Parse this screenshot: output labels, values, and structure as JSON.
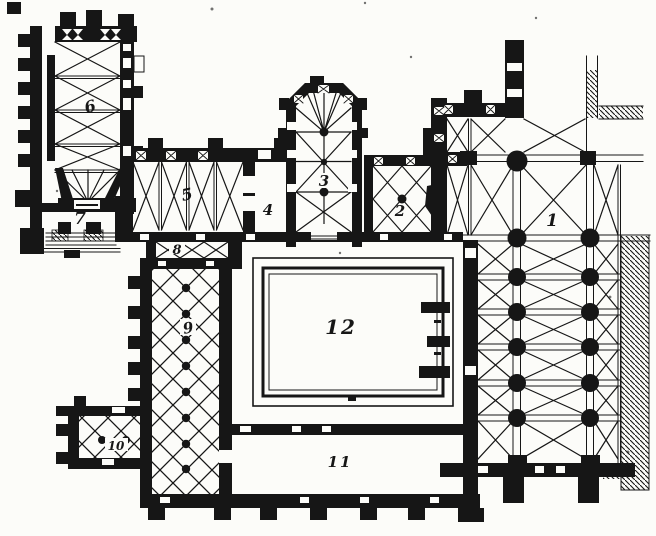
{
  "colors": {
    "ink": "#161616",
    "paper": "#fcfcf9"
  },
  "rooms": [
    {
      "label": "1"
    },
    {
      "label": "2"
    },
    {
      "label": "3"
    },
    {
      "label": "4"
    },
    {
      "label": "5"
    },
    {
      "label": "6"
    },
    {
      "label": "7"
    },
    {
      "label": "8"
    },
    {
      "label": "9"
    },
    {
      "label": "10"
    },
    {
      "label": "11"
    },
    {
      "label": "12"
    }
  ]
}
